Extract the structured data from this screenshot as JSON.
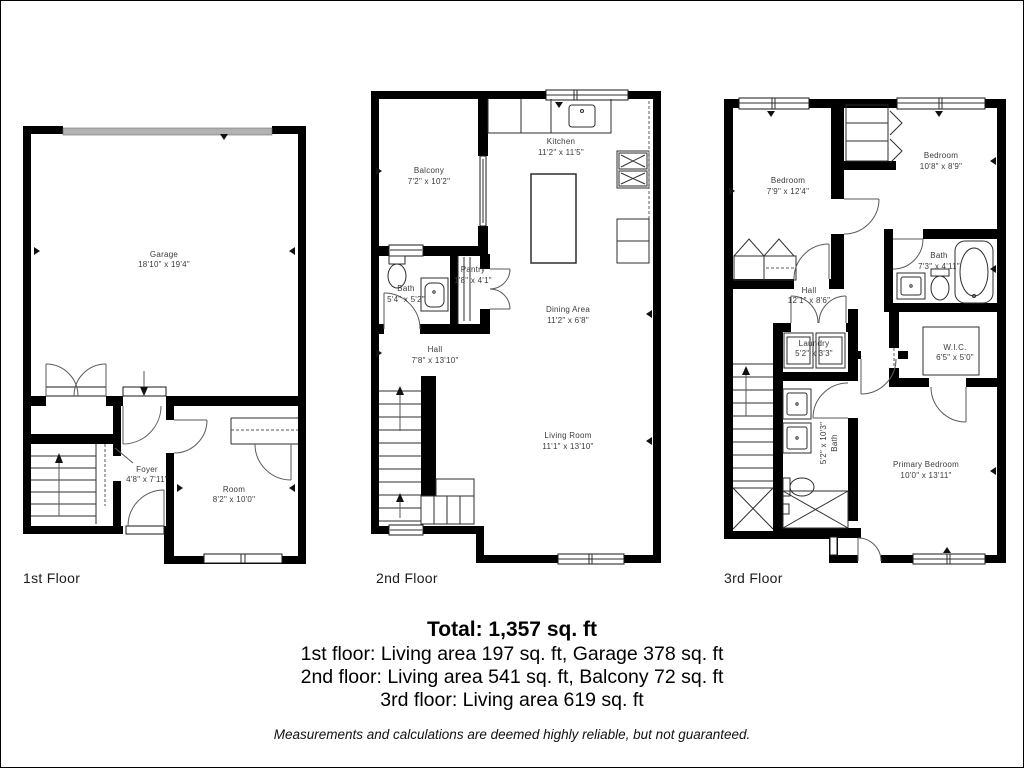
{
  "colors": {
    "wall": "#000000",
    "garage_door": "#b3b3b3",
    "label_text": "#3a3a3a",
    "line": "#2e2e2e"
  },
  "floors": [
    {
      "name": "1st Floor",
      "rooms": {
        "garage": {
          "label": "Garage",
          "dims": "18'10\" x 19'4\""
        },
        "foyer": {
          "label": "Foyer",
          "dims": "4'8\" x 7'11\""
        },
        "room": {
          "label": "Room",
          "dims": "8'2\" x 10'0\""
        }
      }
    },
    {
      "name": "2nd Floor",
      "rooms": {
        "balcony": {
          "label": "Balcony",
          "dims": "7'2\" x 10'2\""
        },
        "kitchen": {
          "label": "Kitchen",
          "dims": "11'2\" x 11'5\""
        },
        "bath": {
          "label": "Bath",
          "dims": "5'4\" x 5'2\""
        },
        "pantry": {
          "label": "Pantry",
          "dims": "1'8\" x 4'1\""
        },
        "dining": {
          "label": "Dining Area",
          "dims": "11'2\" x 6'8\""
        },
        "hall": {
          "label": "Hall",
          "dims": "7'8\" x 13'10\""
        },
        "living": {
          "label": "Living Room",
          "dims": "11'1\" x 13'10\""
        }
      }
    },
    {
      "name": "3rd Floor",
      "rooms": {
        "bedroom_left": {
          "label": "Bedroom",
          "dims": "7'9\" x 12'4\""
        },
        "bedroom_right": {
          "label": "Bedroom",
          "dims": "10'8\" x 8'9\""
        },
        "bath_right": {
          "label": "Bath",
          "dims": "7'3\" x 4'11\""
        },
        "hall": {
          "label": "Hall",
          "dims": "12'1\" x 8'6\""
        },
        "laundry": {
          "label": "Laundry",
          "dims": "5'2\" x 3'3\""
        },
        "wic": {
          "label": "W.I.C.",
          "dims": "6'5\" x 5'0\""
        },
        "bath_vertical": {
          "label": "Bath",
          "dims": "5'2\" x 10'3\""
        },
        "primary": {
          "label": "Primary Bedroom",
          "dims": "10'0\" x 13'11\""
        }
      }
    }
  ],
  "summary": {
    "total": "Total: 1,357 sq. ft",
    "floor1": "1st floor: Living area 197 sq. ft, Garage 378 sq. ft",
    "floor2": "2nd floor: Living area 541 sq. ft, Balcony 72 sq. ft",
    "floor3": "3rd floor: Living area 619 sq. ft",
    "disclaimer": "Measurements and calculations are deemed highly reliable, but not guaranteed."
  }
}
